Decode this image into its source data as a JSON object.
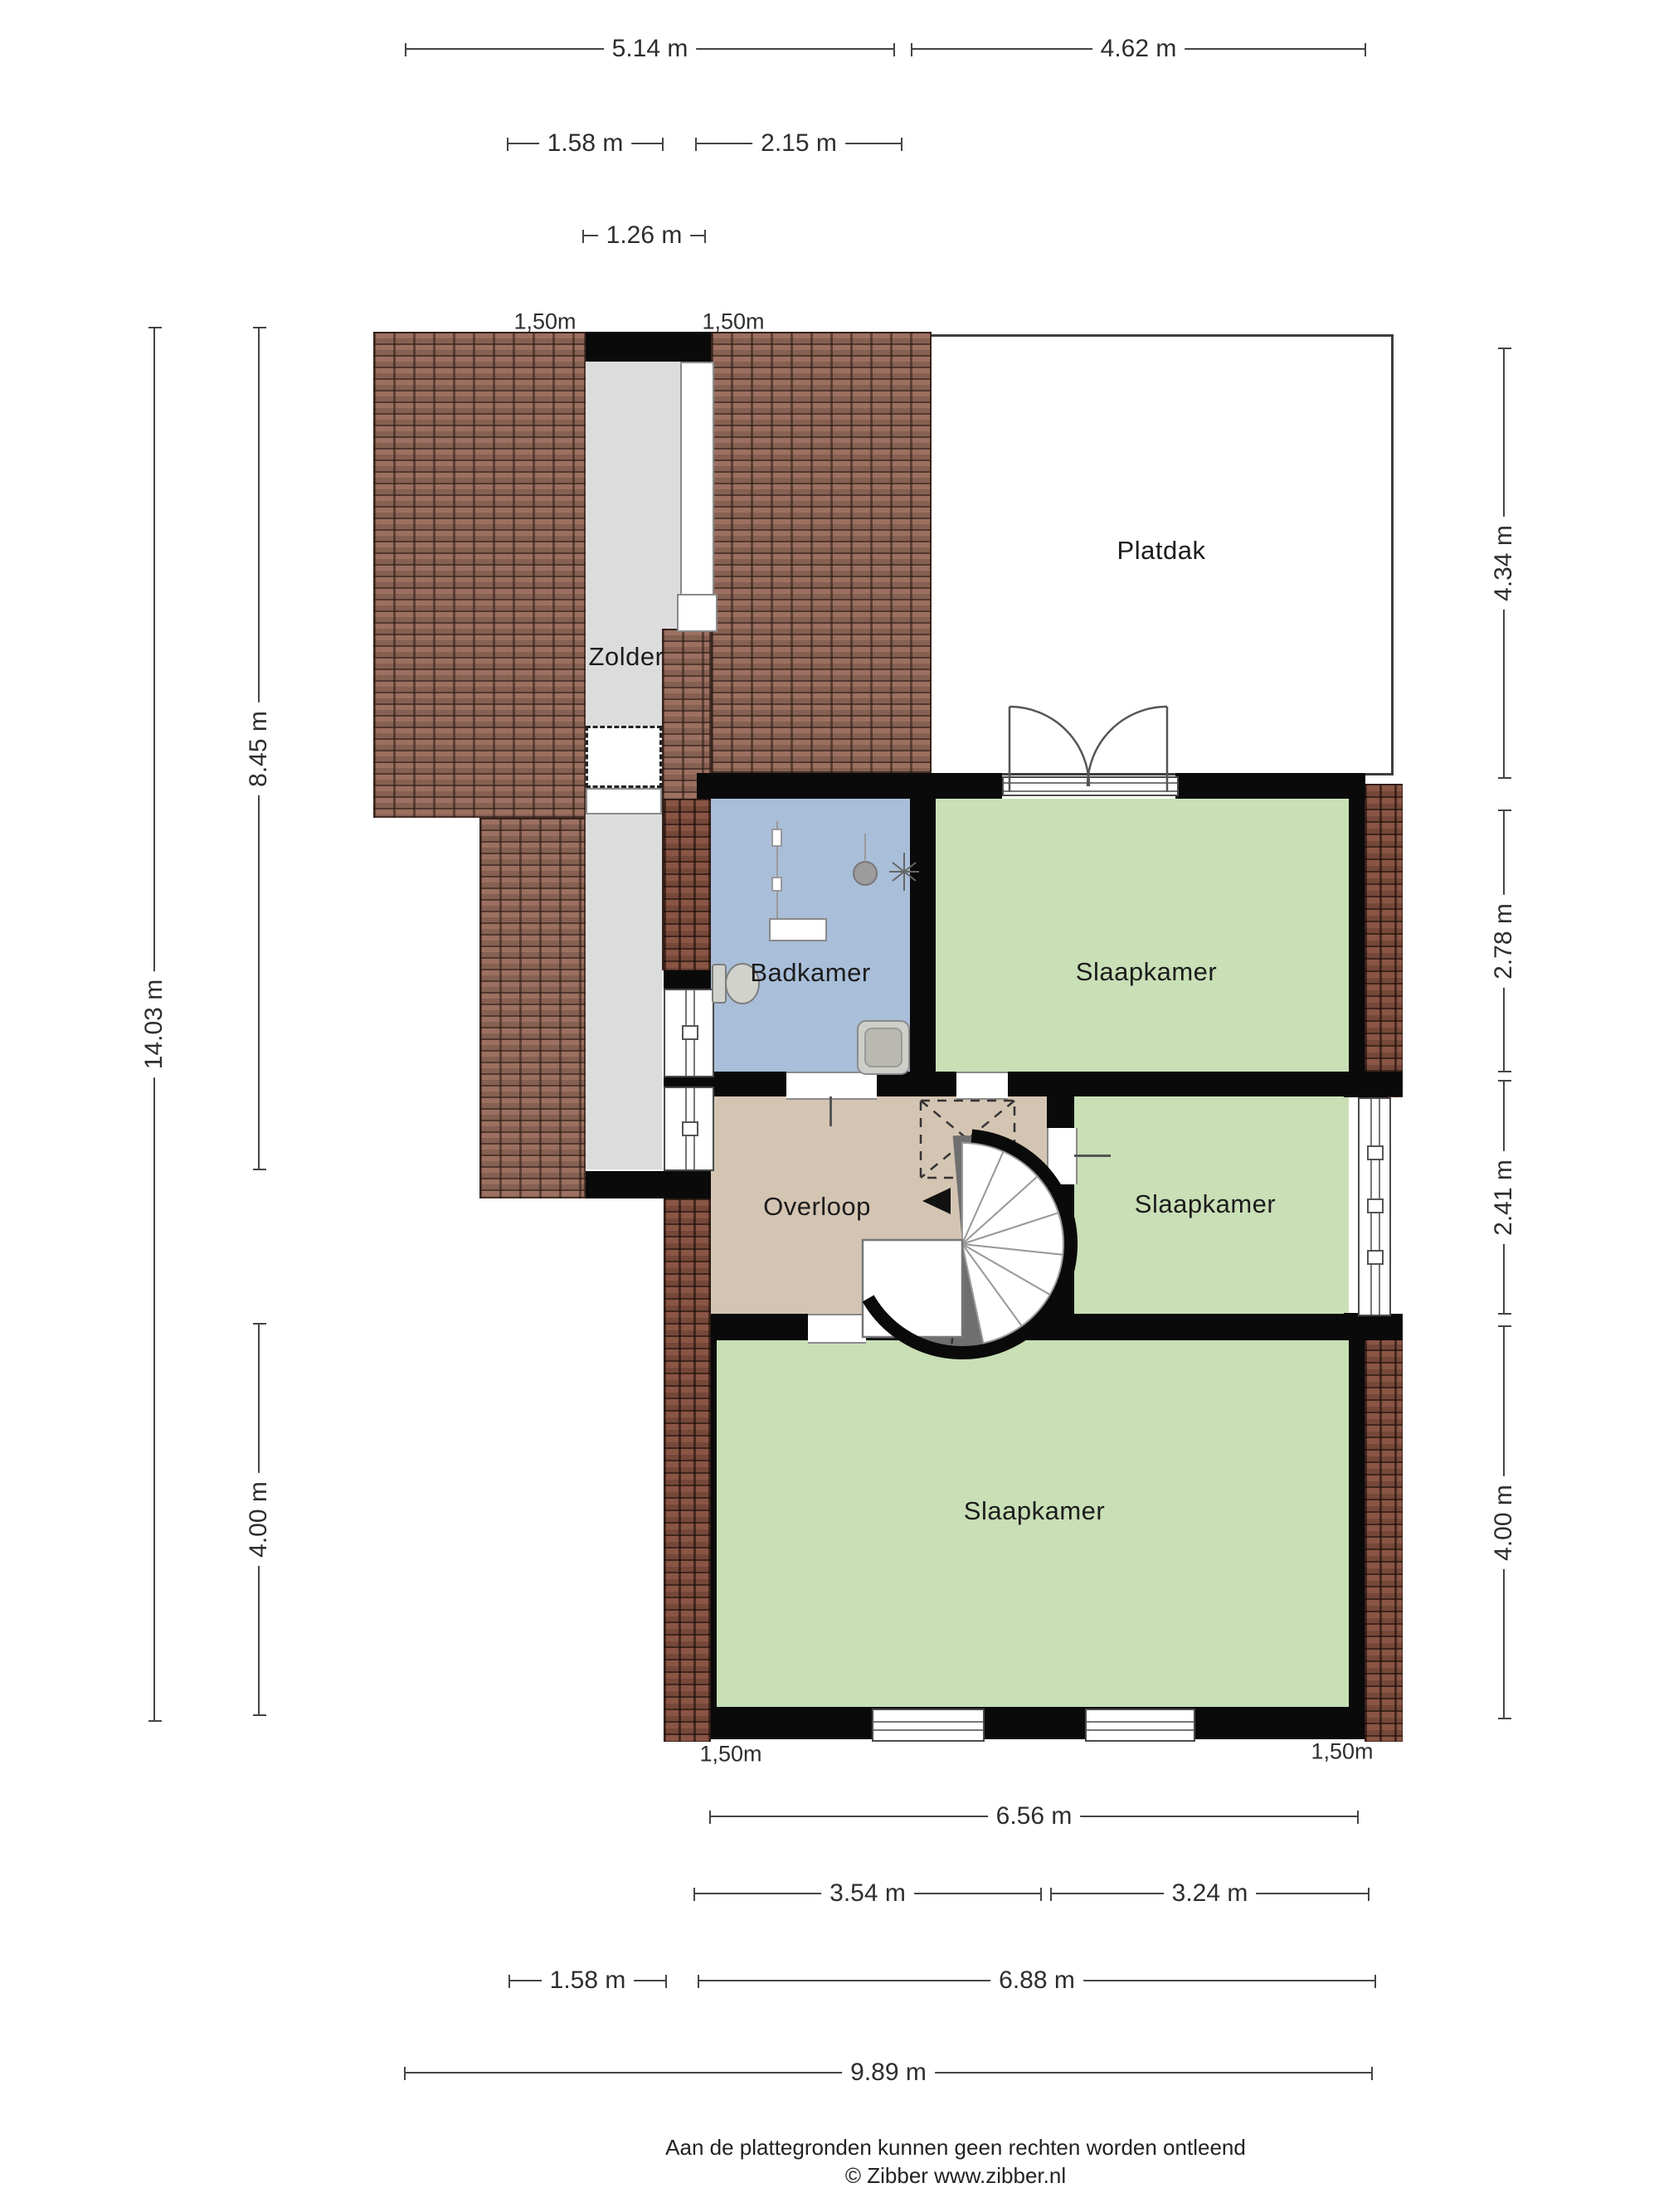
{
  "rooms": {
    "zolder": "Zolder",
    "platdak": "Platdak",
    "badkamer": "Badkamer",
    "slaapkamer_1": "Slaapkamer",
    "overloop": "Overloop",
    "slaapkamer_2": "Slaapkamer",
    "slaapkamer_3": "Slaapkamer"
  },
  "dimensions": {
    "top": [
      "5.14 m",
      "4.62 m",
      "1.58 m",
      "2.15 m",
      "1.26 m"
    ],
    "roof_width_labels_top": [
      "1,50m",
      "1,50m"
    ],
    "left": [
      "14.03 m",
      "8.45 m",
      "4.00 m"
    ],
    "right": [
      "4.34 m",
      "2.78 m",
      "2.41 m",
      "4.00 m"
    ],
    "roof_width_labels_bottom": [
      "1,50m",
      "1,50m"
    ],
    "bottom": [
      "6.56 m",
      "3.54 m",
      "3.24 m",
      "1.58 m",
      "6.88 m",
      "9.89 m"
    ]
  },
  "footer": {
    "disclaimer": "Aan de plattegronden kunnen geen rechten worden ontleend",
    "credit": "© Zibber www.zibber.nl"
  },
  "colors": {
    "wall": "#0a0a0a",
    "roof_tile": "#9c7060",
    "brick_wall": "#8a5544",
    "attic_floor": "#dcdcdc",
    "flat_roof": "#ffffff",
    "bathroom": "#a9bed9",
    "bedroom": "#c9dfb6",
    "landing": "#d4c5b3",
    "stair_fill": "#6f6f6f"
  }
}
